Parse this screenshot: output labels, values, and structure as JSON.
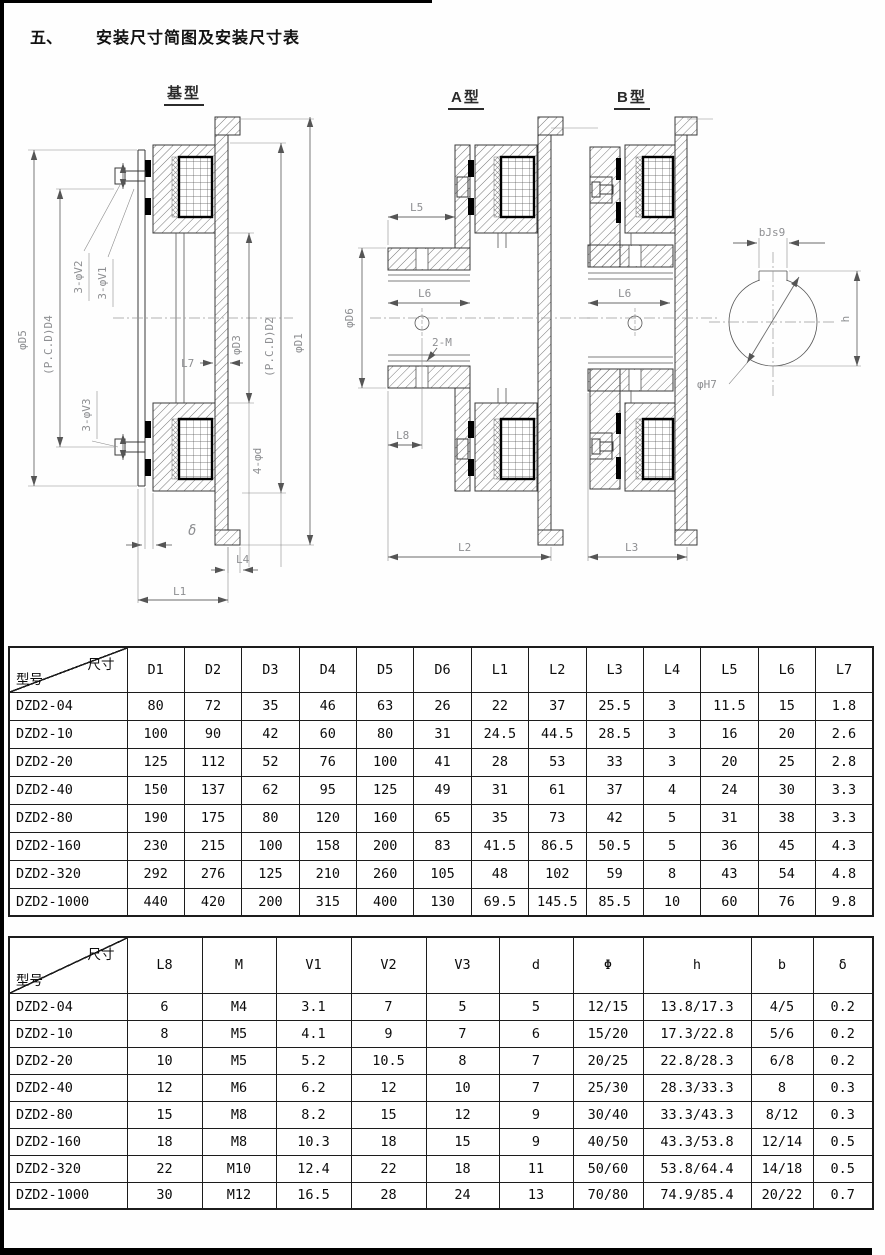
{
  "page": {
    "section_no": "五、",
    "title": "安装尺寸简图及安装尺寸表"
  },
  "drawings": {
    "base": {
      "label": "基型",
      "labels": {
        "d5": "φD5",
        "pcd_d4": "(P.C.D)D4",
        "v2": "3-φV2",
        "v1": "3-φV1",
        "v3": "3-φV3",
        "d3": "φD3",
        "pcd_d2": "(P.C.D)D2",
        "d1": "φD1",
        "l7": "L7",
        "holes": "4-φd",
        "delta": "δ",
        "l4": "L4",
        "l1": "L1"
      }
    },
    "type_a": {
      "label": "A型",
      "labels": {
        "l5": "L5",
        "l6": "L6",
        "d6": "φD6",
        "m": "2-M",
        "l8": "L8",
        "l2": "L2"
      }
    },
    "type_b": {
      "label": "B型",
      "labels": {
        "l6": "L6",
        "l3": "L3"
      }
    },
    "keyway": {
      "labels": {
        "b": "bJs9",
        "h": "h",
        "bore": "φH7"
      }
    }
  },
  "table1": {
    "corner_top": "尺寸",
    "corner_bottom": "型号",
    "columns": [
      "D1",
      "D2",
      "D3",
      "D4",
      "D5",
      "D6",
      "L1",
      "L2",
      "L3",
      "L4",
      "L5",
      "L6",
      "L7"
    ],
    "rows": [
      {
        "model": "DZD2-04",
        "values": [
          "80",
          "72",
          "35",
          "46",
          "63",
          "26",
          "22",
          "37",
          "25.5",
          "3",
          "11.5",
          "15",
          "1.8"
        ]
      },
      {
        "model": "DZD2-10",
        "values": [
          "100",
          "90",
          "42",
          "60",
          "80",
          "31",
          "24.5",
          "44.5",
          "28.5",
          "3",
          "16",
          "20",
          "2.6"
        ]
      },
      {
        "model": "DZD2-20",
        "values": [
          "125",
          "112",
          "52",
          "76",
          "100",
          "41",
          "28",
          "53",
          "33",
          "3",
          "20",
          "25",
          "2.8"
        ]
      },
      {
        "model": "DZD2-40",
        "values": [
          "150",
          "137",
          "62",
          "95",
          "125",
          "49",
          "31",
          "61",
          "37",
          "4",
          "24",
          "30",
          "3.3"
        ]
      },
      {
        "model": "DZD2-80",
        "values": [
          "190",
          "175",
          "80",
          "120",
          "160",
          "65",
          "35",
          "73",
          "42",
          "5",
          "31",
          "38",
          "3.3"
        ]
      },
      {
        "model": "DZD2-160",
        "values": [
          "230",
          "215",
          "100",
          "158",
          "200",
          "83",
          "41.5",
          "86.5",
          "50.5",
          "5",
          "36",
          "45",
          "4.3"
        ]
      },
      {
        "model": "DZD2-320",
        "values": [
          "292",
          "276",
          "125",
          "210",
          "260",
          "105",
          "48",
          "102",
          "59",
          "8",
          "43",
          "54",
          "4.8"
        ]
      },
      {
        "model": "DZD2-1000",
        "values": [
          "440",
          "420",
          "200",
          "315",
          "400",
          "130",
          "69.5",
          "145.5",
          "85.5",
          "10",
          "60",
          "76",
          "9.8"
        ]
      }
    ]
  },
  "table2": {
    "corner_top": "尺寸",
    "corner_bottom": "型号",
    "columns": [
      "L8",
      "M",
      "V1",
      "V2",
      "V3",
      "d",
      "Φ",
      "h",
      "b",
      "δ"
    ],
    "rows": [
      {
        "model": "DZD2-04",
        "values": [
          "6",
          "M4",
          "3.1",
          "7",
          "5",
          "5",
          "12/15",
          "13.8/17.3",
          "4/5",
          "0.2"
        ]
      },
      {
        "model": "DZD2-10",
        "values": [
          "8",
          "M5",
          "4.1",
          "9",
          "7",
          "6",
          "15/20",
          "17.3/22.8",
          "5/6",
          "0.2"
        ]
      },
      {
        "model": "DZD2-20",
        "values": [
          "10",
          "M5",
          "5.2",
          "10.5",
          "8",
          "7",
          "20/25",
          "22.8/28.3",
          "6/8",
          "0.2"
        ]
      },
      {
        "model": "DZD2-40",
        "values": [
          "12",
          "M6",
          "6.2",
          "12",
          "10",
          "7",
          "25/30",
          "28.3/33.3",
          "8",
          "0.3"
        ]
      },
      {
        "model": "DZD2-80",
        "values": [
          "15",
          "M8",
          "8.2",
          "15",
          "12",
          "9",
          "30/40",
          "33.3/43.3",
          "8/12",
          "0.3"
        ]
      },
      {
        "model": "DZD2-160",
        "values": [
          "18",
          "M8",
          "10.3",
          "18",
          "15",
          "9",
          "40/50",
          "43.3/53.8",
          "12/14",
          "0.5"
        ]
      },
      {
        "model": "DZD2-320",
        "values": [
          "22",
          "M10",
          "12.4",
          "22",
          "18",
          "11",
          "50/60",
          "53.8/64.4",
          "14/18",
          "0.5"
        ]
      },
      {
        "model": "DZD2-1000",
        "values": [
          "30",
          "M12",
          "16.5",
          "28",
          "24",
          "13",
          "70/80",
          "74.9/85.4",
          "20/22",
          "0.7"
        ]
      }
    ]
  }
}
